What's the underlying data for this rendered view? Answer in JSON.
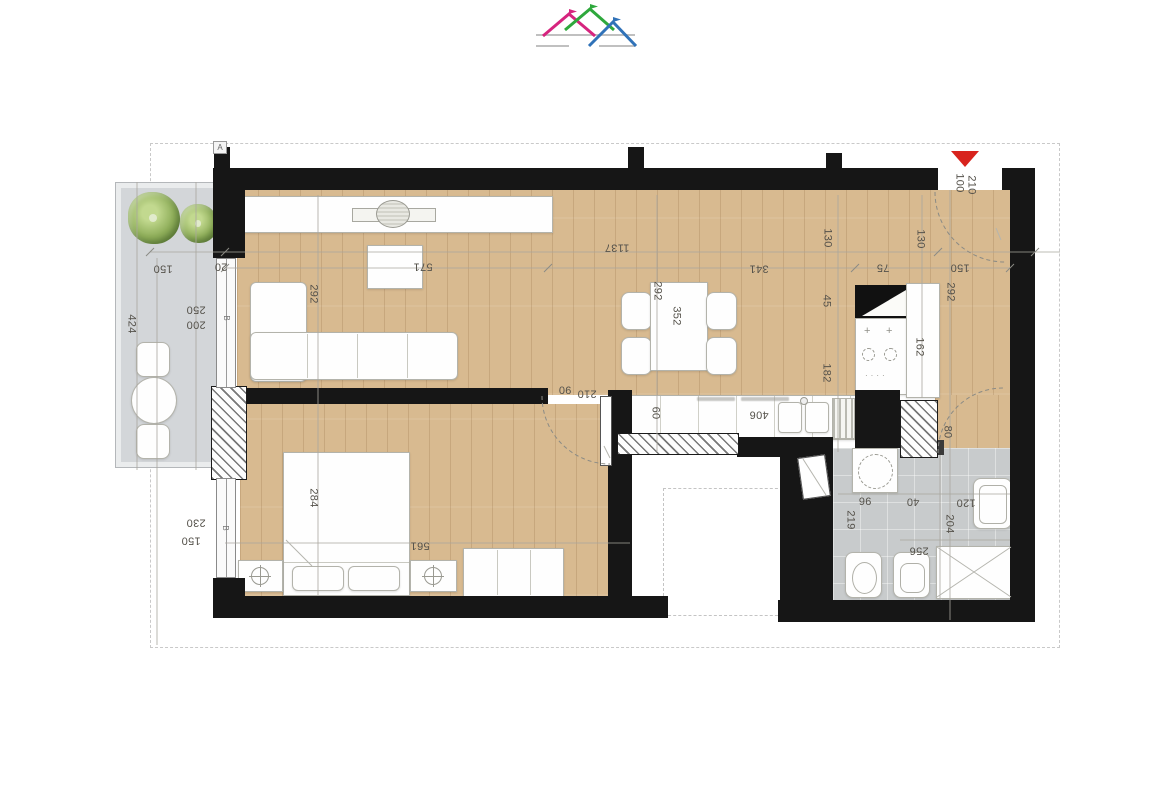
{
  "logo": {
    "roof_colors": [
      "#d6247e",
      "#2ea83c",
      "#3072b8"
    ],
    "underline_color": "#c0c0c0"
  },
  "plan": {
    "colors": {
      "wood": "#d8ba90",
      "terrace": "#d3d6d9",
      "tile": "#c8cbcc",
      "wall": "#161616",
      "accentRed": "#d8231d"
    },
    "entrance_marker": "red-triangle",
    "dimension_labels": [
      {
        "t": "150",
        "x": 163,
        "y": 268,
        "r": 180
      },
      {
        "t": "20",
        "x": 221,
        "y": 266,
        "r": 180
      },
      {
        "t": "250",
        "x": 196,
        "y": 309,
        "r": 180
      },
      {
        "t": "200",
        "x": 196,
        "y": 324,
        "r": 180
      },
      {
        "t": "424",
        "x": 131,
        "y": 324,
        "r": 90
      },
      {
        "t": "230",
        "x": 196,
        "y": 522,
        "r": 180
      },
      {
        "t": "150",
        "x": 191,
        "y": 540,
        "r": 180
      },
      {
        "t": "292",
        "x": 313,
        "y": 294,
        "r": 90
      },
      {
        "t": "571",
        "x": 423,
        "y": 266,
        "r": 180
      },
      {
        "t": "1137",
        "x": 617,
        "y": 247,
        "r": 180
      },
      {
        "t": "341",
        "x": 759,
        "y": 268,
        "r": 180
      },
      {
        "t": "292",
        "x": 657,
        "y": 291,
        "r": 90
      },
      {
        "t": "352",
        "x": 676,
        "y": 316,
        "r": 90
      },
      {
        "t": "130",
        "x": 827,
        "y": 238,
        "r": 90
      },
      {
        "t": "130",
        "x": 920,
        "y": 239,
        "r": 90
      },
      {
        "t": "75",
        "x": 883,
        "y": 267,
        "r": 180
      },
      {
        "t": "150",
        "x": 960,
        "y": 267,
        "r": 180
      },
      {
        "t": "45",
        "x": 826,
        "y": 301,
        "r": 90
      },
      {
        "t": "292",
        "x": 950,
        "y": 292,
        "r": 90
      },
      {
        "t": "162",
        "x": 919,
        "y": 347,
        "r": 90
      },
      {
        "t": "182",
        "x": 826,
        "y": 373,
        "r": 90
      },
      {
        "t": "100",
        "x": 959,
        "y": 183,
        "r": 90
      },
      {
        "t": "210",
        "x": 971,
        "y": 185,
        "r": 90
      },
      {
        "t": "60",
        "x": 655,
        "y": 413,
        "r": 90
      },
      {
        "t": "406",
        "x": 759,
        "y": 414,
        "r": 180
      },
      {
        "t": "90",
        "x": 565,
        "y": 389,
        "r": 180
      },
      {
        "t": "210",
        "x": 587,
        "y": 393,
        "r": 180
      },
      {
        "t": "284",
        "x": 313,
        "y": 498,
        "r": 90
      },
      {
        "t": "561",
        "x": 420,
        "y": 545,
        "r": 180
      },
      {
        "t": "80",
        "x": 947,
        "y": 432,
        "r": 90
      },
      {
        "t": "219",
        "x": 850,
        "y": 520,
        "r": 90
      },
      {
        "t": "96",
        "x": 865,
        "y": 500,
        "r": 180
      },
      {
        "t": "40",
        "x": 913,
        "y": 501,
        "r": 180
      },
      {
        "t": "120",
        "x": 966,
        "y": 502,
        "r": 180
      },
      {
        "t": "204",
        "x": 949,
        "y": 524,
        "r": 90
      },
      {
        "t": "256",
        "x": 919,
        "y": 550,
        "r": 180
      }
    ],
    "wall_markers": [
      {
        "t": "A",
        "x": 221,
        "y": 147,
        "r": 0,
        "boxed": true
      },
      {
        "t": "B",
        "x": 226,
        "y": 318,
        "r": 90,
        "boxed": false
      },
      {
        "t": "B",
        "x": 225,
        "y": 528,
        "r": 90,
        "boxed": false
      }
    ]
  }
}
